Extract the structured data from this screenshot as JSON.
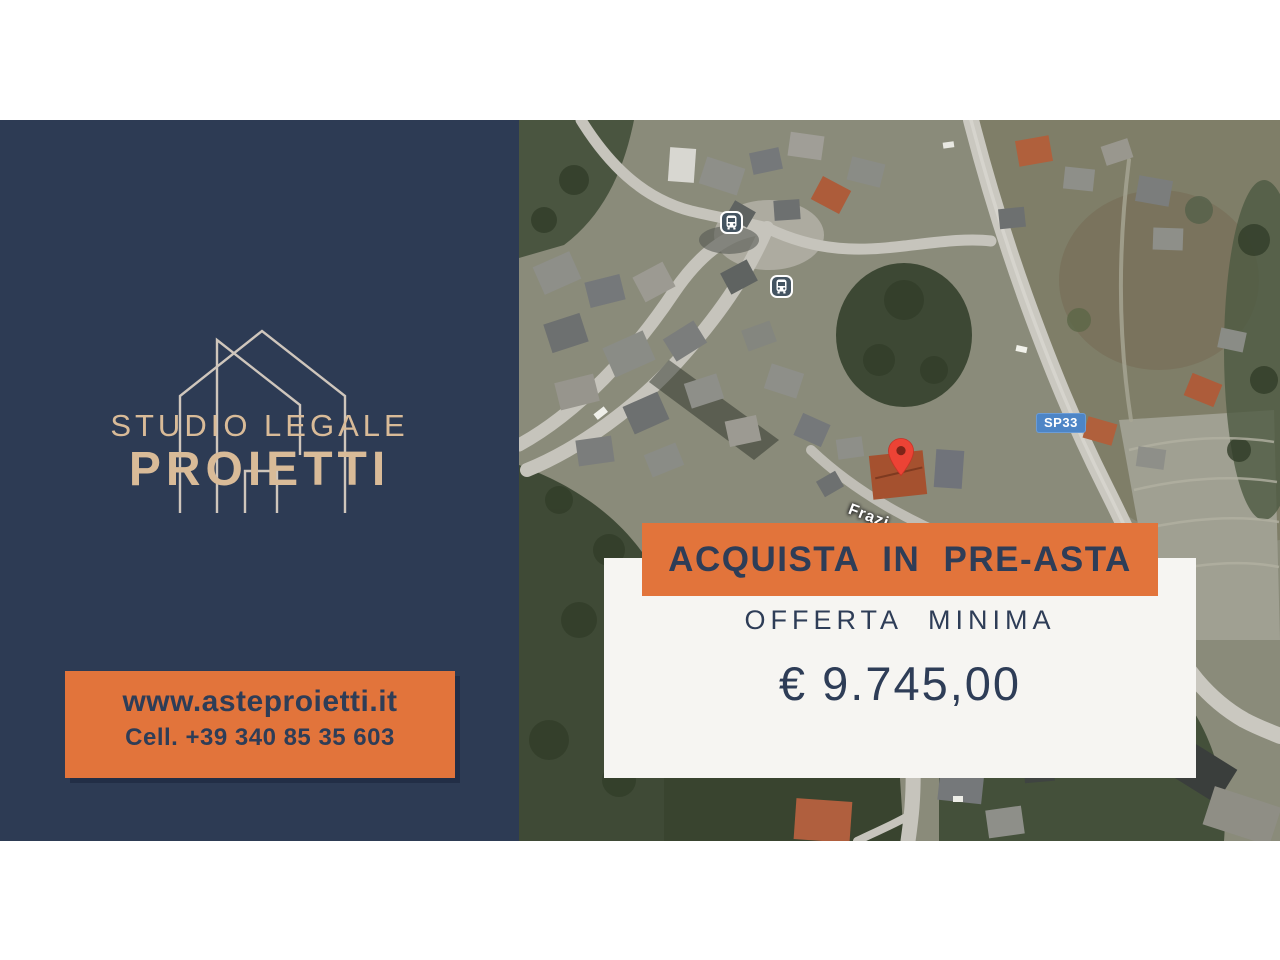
{
  "brand": {
    "title_line1": "STUDIO LEGALE",
    "title_line2": "PROIETTI",
    "panel_color": "#2d3b54",
    "accent_color": "#d9bb98",
    "logo": "house-outline"
  },
  "contact": {
    "website": "www.asteproietti.it",
    "phone": "Cell. +39 340 85 35 603",
    "box_color": "#e2743b",
    "text_color": "#2e3d57"
  },
  "offer": {
    "banner_label": "ACQUISTA IN PRE-ASTA",
    "minimum_label": "OFFERTA MINIMA",
    "amount": "€ 9.745,00",
    "banner_color": "#e2743b",
    "card_color": "#f6f5f2",
    "text_color": "#2e3d57"
  },
  "map": {
    "type": "satellite",
    "road_badge": "SP33",
    "street_label": "Frazi",
    "badge_color": "#4d85c6",
    "pin_color": "#ec4335",
    "markers": [
      "map-pin",
      "bus-stop",
      "bus-stop"
    ]
  }
}
